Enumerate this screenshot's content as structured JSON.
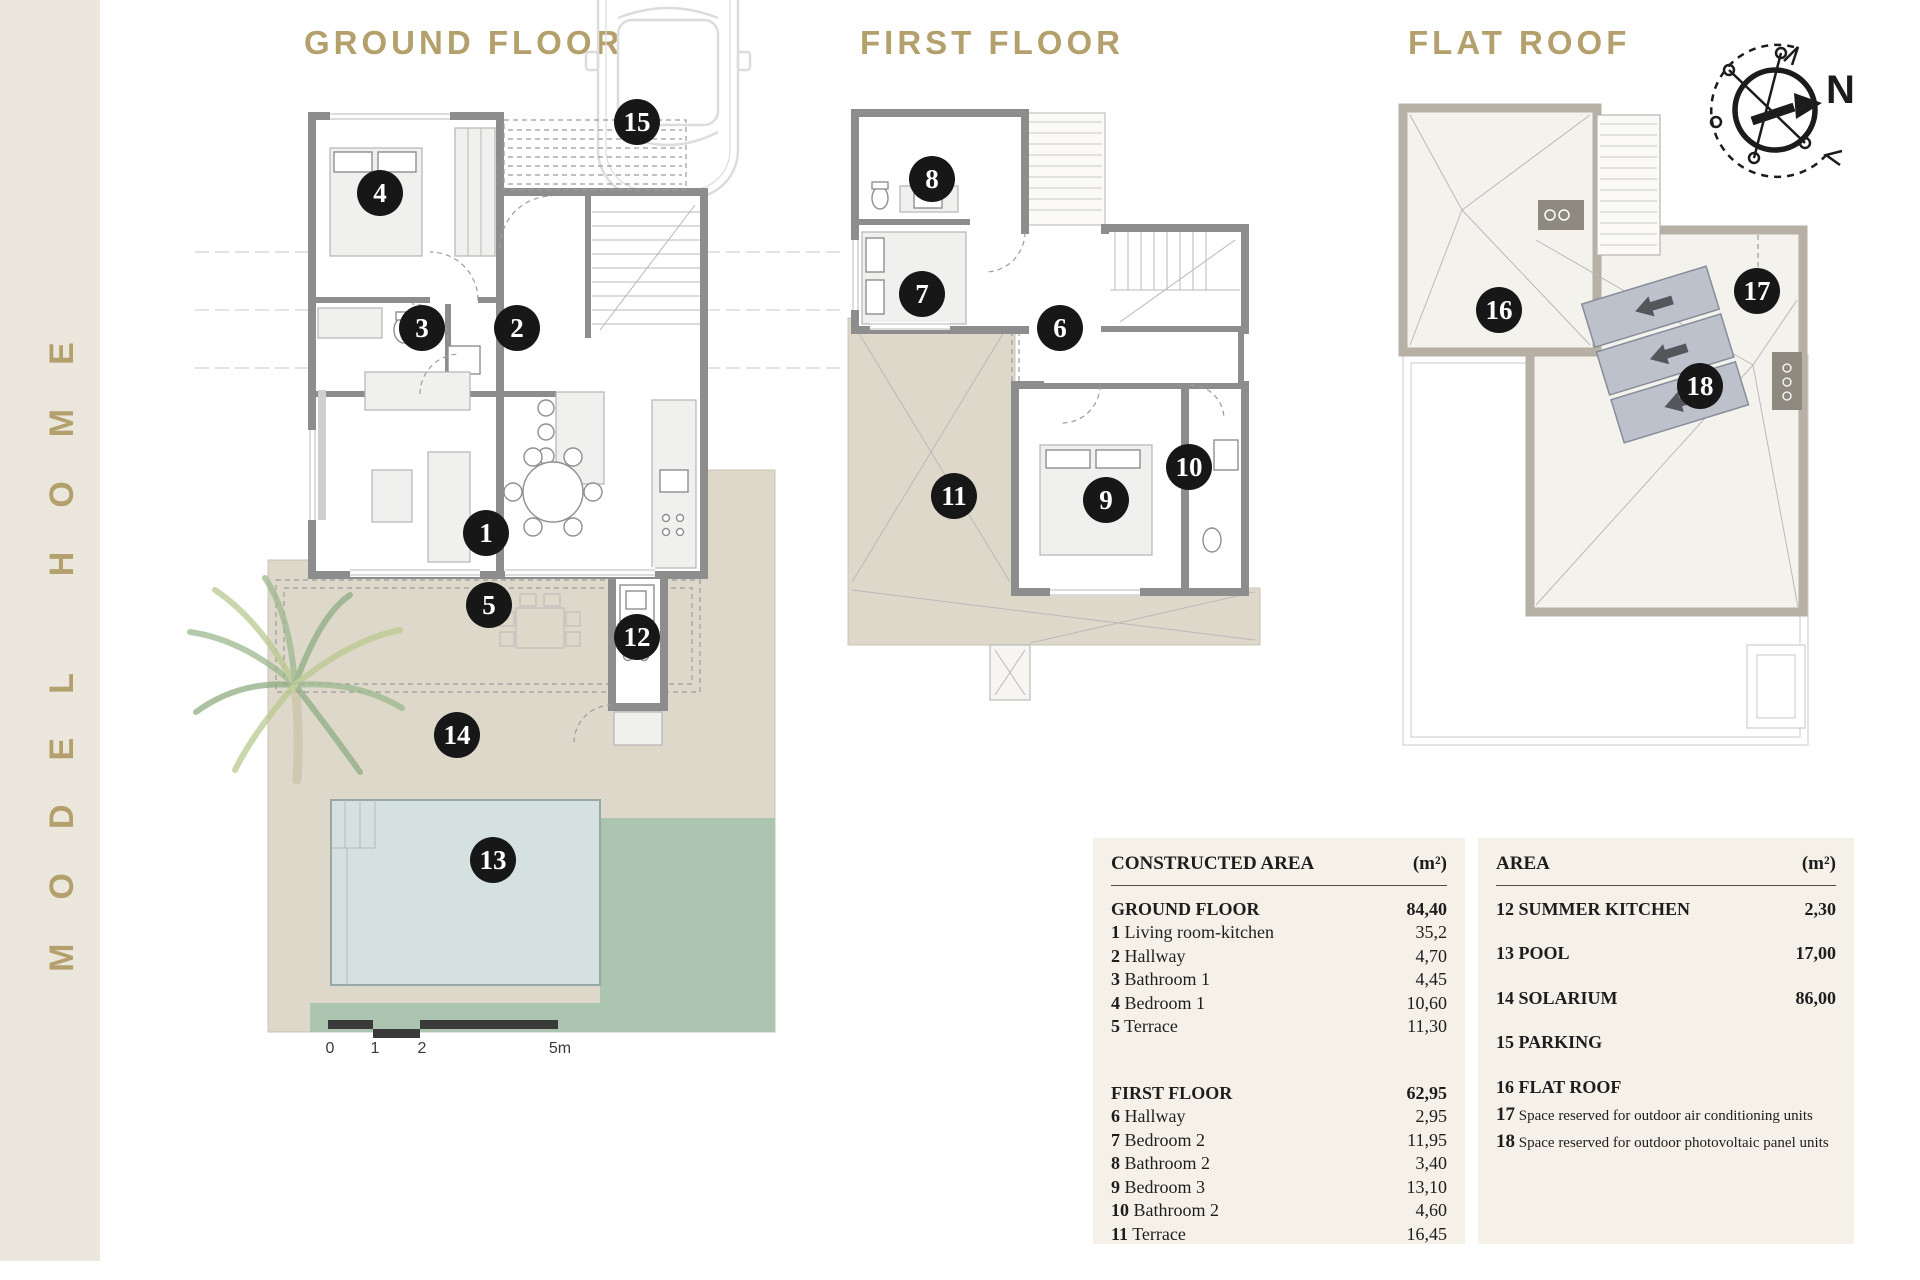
{
  "sidebar": {
    "brand": "MODEL HOME"
  },
  "plans": {
    "ground": {
      "title": "GROUND FLOOR"
    },
    "first": {
      "title": "FIRST FLOOR"
    },
    "roof": {
      "title": "FLAT ROOF"
    }
  },
  "compass": {
    "label": "N"
  },
  "scale_bar": {
    "labels": [
      "0",
      "1",
      "2",
      "5m"
    ]
  },
  "markers": [
    {
      "n": "1",
      "plan": "ground-living-room-kitchen",
      "x": 486,
      "y": 533
    },
    {
      "n": "2",
      "plan": "ground-hallway",
      "x": 517,
      "y": 328
    },
    {
      "n": "3",
      "plan": "ground-bathroom-1",
      "x": 422,
      "y": 328
    },
    {
      "n": "4",
      "plan": "ground-bedroom-1",
      "x": 380,
      "y": 193
    },
    {
      "n": "5",
      "plan": "ground-terrace",
      "x": 489,
      "y": 605
    },
    {
      "n": "12",
      "plan": "ground-summer-kitchen",
      "x": 637,
      "y": 637
    },
    {
      "n": "13",
      "plan": "ground-pool",
      "x": 493,
      "y": 860
    },
    {
      "n": "14",
      "plan": "ground-solarium",
      "x": 457,
      "y": 735
    },
    {
      "n": "15",
      "plan": "ground-parking",
      "x": 637,
      "y": 122
    },
    {
      "n": "6",
      "plan": "first-hallway",
      "x": 1060,
      "y": 328
    },
    {
      "n": "7",
      "plan": "first-bedroom-2",
      "x": 922,
      "y": 294
    },
    {
      "n": "8",
      "plan": "first-bathroom-2",
      "x": 932,
      "y": 179
    },
    {
      "n": "9",
      "plan": "first-bedroom-3",
      "x": 1106,
      "y": 500
    },
    {
      "n": "10",
      "plan": "first-bathroom-2b",
      "x": 1189,
      "y": 467
    },
    {
      "n": "11",
      "plan": "first-terrace",
      "x": 954,
      "y": 496
    },
    {
      "n": "16",
      "plan": "roof-flat-roof",
      "x": 1499,
      "y": 310
    },
    {
      "n": "17",
      "plan": "roof-ac-space",
      "x": 1757,
      "y": 291
    },
    {
      "n": "18",
      "plan": "roof-photovoltaic-space",
      "x": 1700,
      "y": 386
    }
  ],
  "tables": {
    "constructed": {
      "title": "CONSTRUCTED AREA",
      "unit": "(m²)",
      "sections": [
        {
          "name": "GROUND FLOOR",
          "total": "84,40",
          "rows": [
            [
              "1",
              "Living room-kitchen",
              "35,2"
            ],
            [
              "2",
              "Hallway",
              "4,70"
            ],
            [
              "3",
              "Bathroom 1",
              "4,45"
            ],
            [
              "4",
              "Bedroom 1",
              "10,60"
            ],
            [
              "5",
              "Terrace",
              "11,30"
            ]
          ]
        },
        {
          "name": "FIRST FLOOR",
          "total": "62,95",
          "rows": [
            [
              "6",
              "Hallway",
              "2,95"
            ],
            [
              "7",
              "Bedroom 2",
              "11,95"
            ],
            [
              "8",
              "Bathroom 2",
              "3,40"
            ],
            [
              "9",
              "Bedroom 3",
              "13,10"
            ],
            [
              "10",
              "Bathroom 2",
              "4,60"
            ],
            [
              "11",
              "Terrace",
              "16,45"
            ]
          ]
        }
      ]
    },
    "area": {
      "title": "AREA",
      "unit": "(m²)",
      "rows": [
        {
          "n": "12",
          "label": "SUMMER KITCHEN",
          "value": "2,30",
          "small": false
        },
        {
          "n": "13",
          "label": "POOL",
          "value": "17,00",
          "small": false
        },
        {
          "n": "14",
          "label": "SOLARIUM",
          "value": "86,00",
          "small": false
        },
        {
          "n": "15",
          "label": "PARKING",
          "value": "",
          "small": false
        },
        {
          "n": "16",
          "label": "FLAT ROOF",
          "value": "",
          "small": false
        },
        {
          "n": "17",
          "label": "Space reserved for outdoor air conditioning units",
          "value": "",
          "small": true
        },
        {
          "n": "18",
          "label": "Space reserved for outdoor photovoltaic panel units",
          "value": "",
          "small": true
        }
      ]
    }
  },
  "colors": {
    "gold": "#b3a06c",
    "wall": "#8d8d8d",
    "roof-wall": "#b7b0a5",
    "terrace": "#ddd8ca",
    "pool": "#d5e1e0",
    "lawn": "#abc5b1",
    "table-bg": "#f5f1e8",
    "marker": "#171717"
  }
}
